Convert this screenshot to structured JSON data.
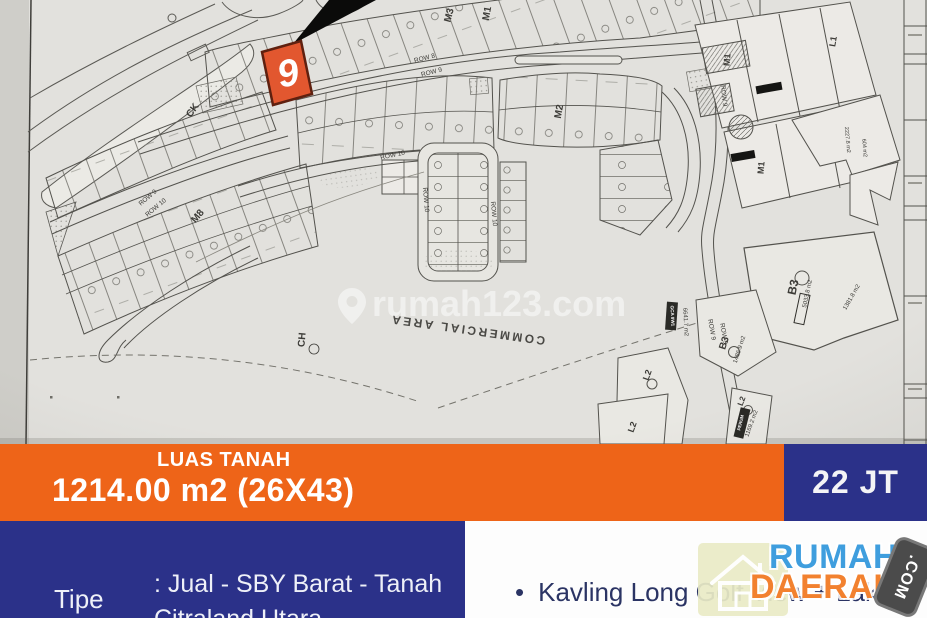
{
  "listing": {
    "land_area_label": "LUAS TANAH",
    "land_area_value": "1214.00 m2 (26X43)",
    "price": "22 JT",
    "type_label": "Tipe",
    "type_value_lines": [
      ": Jual - SBY Barat - Tanah",
      "Citraland Utara"
    ],
    "feature_bullet": "•",
    "feature_lines": [
      "Kavling Long Golf View + Lake",
      "View"
    ]
  },
  "logo": {
    "line1": "RUMAH",
    "line2": "DAERAH",
    "badge": ".COM",
    "icon": "house-icon"
  },
  "colors": {
    "banner_orange": "#ee6418",
    "navy": "#2b3189",
    "highlight_plot": "#e2572f",
    "logo_blue": "#3f9ede",
    "logo_orange": "#f2812f"
  },
  "map": {
    "watermark": "rumah123.com",
    "highlighted_plot": "9",
    "labels": [
      {
        "t": "ROW 8",
        "x": 425,
        "y": 60,
        "r": -14,
        "s": 6.5
      },
      {
        "t": "ROW 9",
        "x": 432,
        "y": 74,
        "r": -14,
        "s": 6.5
      },
      {
        "t": "ROW 9",
        "x": 149,
        "y": 199,
        "r": -40,
        "s": 6.5
      },
      {
        "t": "ROW 10",
        "x": 157,
        "y": 209,
        "r": -40,
        "s": 6.5
      },
      {
        "t": "ROW 10",
        "x": 393,
        "y": 157,
        "r": -12,
        "s": 6.5
      },
      {
        "t": "ROW 10",
        "x": 424,
        "y": 200,
        "r": 85,
        "s": 6.5
      },
      {
        "t": "ROW 10",
        "x": 492,
        "y": 214,
        "r": 85,
        "s": 6.5
      },
      {
        "t": "ROW 9",
        "x": 710,
        "y": 330,
        "r": 80,
        "s": 6.5
      },
      {
        "t": "ROW 9",
        "x": 722,
        "y": 334,
        "r": 80,
        "s": 6.5
      },
      {
        "t": "ROW 9",
        "x": 722,
        "y": 96,
        "r": 84,
        "s": 6.5
      },
      {
        "t": "M3",
        "x": 452,
        "y": 16,
        "r": -75,
        "s": 10,
        "w": 1
      },
      {
        "t": "M1",
        "x": 490,
        "y": 14,
        "r": -80,
        "s": 10,
        "w": 1
      },
      {
        "t": "M1",
        "x": 730,
        "y": 60,
        "r": -85,
        "s": 9,
        "w": 1
      },
      {
        "t": "L1",
        "x": 836,
        "y": 42,
        "r": -80,
        "s": 9,
        "w": 1
      },
      {
        "t": "M1",
        "x": 764,
        "y": 168,
        "r": -85,
        "s": 9,
        "w": 1
      },
      {
        "t": "M2",
        "x": 562,
        "y": 112,
        "r": -80,
        "s": 10,
        "w": 1
      },
      {
        "t": "M8",
        "x": 200,
        "y": 218,
        "r": -50,
        "s": 10,
        "w": 1
      },
      {
        "t": "CK",
        "x": 195,
        "y": 112,
        "r": -55,
        "s": 10,
        "w": 1
      },
      {
        "t": "CH",
        "x": 305,
        "y": 340,
        "r": -85,
        "s": 10,
        "w": 1
      },
      {
        "t": "L2",
        "x": 650,
        "y": 376,
        "r": -70,
        "s": 9,
        "w": 1
      },
      {
        "t": "L2",
        "x": 635,
        "y": 428,
        "r": -70,
        "s": 9,
        "w": 1
      },
      {
        "t": "L2",
        "x": 744,
        "y": 402,
        "r": -70,
        "s": 8,
        "w": 1
      },
      {
        "t": "B3",
        "x": 797,
        "y": 288,
        "r": -78,
        "s": 12,
        "w": 1
      },
      {
        "t": "5033.8 m2",
        "x": 809,
        "y": 294,
        "r": -78,
        "s": 6
      },
      {
        "t": "B3",
        "x": 727,
        "y": 344,
        "r": -72,
        "s": 10,
        "w": 1
      },
      {
        "t": "1486.9 m2",
        "x": 741,
        "y": 350,
        "r": -72,
        "s": 6
      },
      {
        "t": "1381.8 m2",
        "x": 853,
        "y": 298,
        "r": -60,
        "s": 6
      },
      {
        "t": "6641.7 m2",
        "x": 684,
        "y": 322,
        "r": 87,
        "s": 6
      },
      {
        "t": "GCA 9W1",
        "x": 671,
        "y": 316,
        "r": 87,
        "s": 4.6,
        "w": 1,
        "c": "#ffffff"
      },
      {
        "t": "1169.2 m2",
        "x": 753,
        "y": 424,
        "r": -70,
        "s": 6
      },
      {
        "t": "PERUM",
        "x": 742,
        "y": 423,
        "r": -76,
        "s": 4.4,
        "w": 1,
        "c": "#ffffff"
      },
      {
        "t": "2227.8 m2",
        "x": 846,
        "y": 140,
        "r": 85,
        "s": 5.5
      },
      {
        "t": "604 m2",
        "x": 863,
        "y": 148,
        "r": 85,
        "s": 5.5
      },
      {
        "t": "COMMERCIAL AREA",
        "x": 468,
        "y": 326,
        "r": 188,
        "s": 12,
        "w": 1,
        "c": "#4a4945",
        "sp": 2.5
      }
    ]
  }
}
